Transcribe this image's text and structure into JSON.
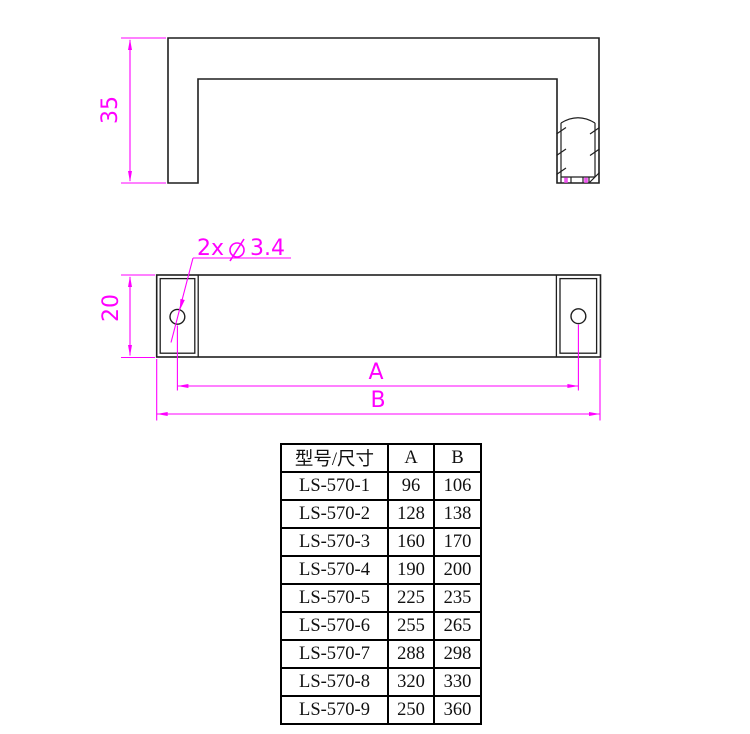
{
  "drawing": {
    "side_view": {
      "height_dim": "35"
    },
    "front_view": {
      "cap_dim": "20",
      "hole_label_prefix": "2x",
      "hole_label_diameter_icon": "diameter-symbol-icon",
      "hole_label_value": "3.4",
      "dim_a_label": "A",
      "dim_b_label": "B"
    },
    "colors": {
      "dimension_magenta": "#ff00ff",
      "outline": "#1f1f1f",
      "background": "#ffffff"
    }
  },
  "table": {
    "headers": [
      "型号/尺寸",
      "A",
      "B"
    ],
    "rows": [
      {
        "model": "LS-570-1",
        "a": "96",
        "b": "106"
      },
      {
        "model": "LS-570-2",
        "a": "128",
        "b": "138"
      },
      {
        "model": "LS-570-3",
        "a": "160",
        "b": "170"
      },
      {
        "model": "LS-570-4",
        "a": "190",
        "b": "200"
      },
      {
        "model": "LS-570-5",
        "a": "225",
        "b": "235"
      },
      {
        "model": "LS-570-6",
        "a": "255",
        "b": "265"
      },
      {
        "model": "LS-570-7",
        "a": "288",
        "b": "298"
      },
      {
        "model": "LS-570-8",
        "a": "320",
        "b": "330"
      },
      {
        "model": "LS-570-9",
        "a": "250",
        "b": "360"
      }
    ]
  }
}
